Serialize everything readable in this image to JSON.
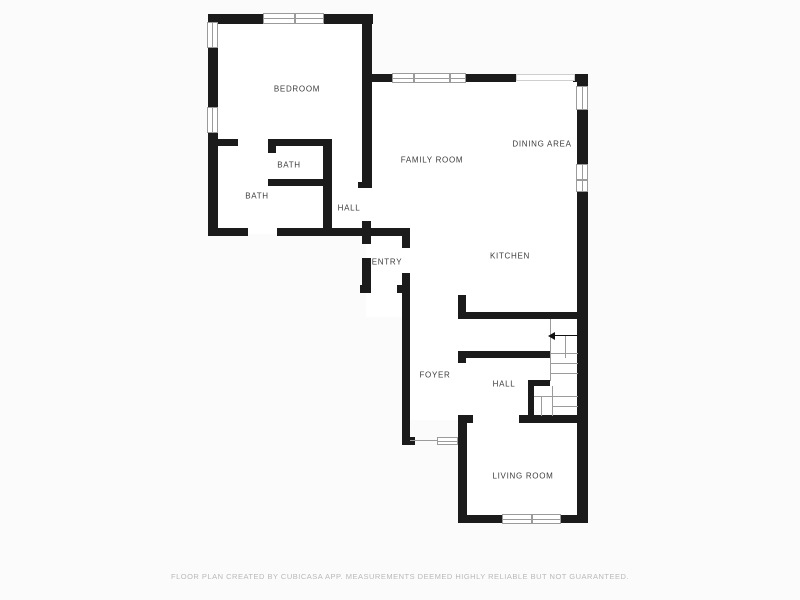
{
  "rooms": [
    {
      "label": "BEDROOM"
    },
    {
      "label": "BATH"
    },
    {
      "label": "BATH"
    },
    {
      "label": "HALL"
    },
    {
      "label": "FAMILY ROOM"
    },
    {
      "label": "DINING AREA"
    },
    {
      "label": "KITCHEN"
    },
    {
      "label": "ENTRY"
    },
    {
      "label": "FOYER"
    },
    {
      "label": "HALL"
    },
    {
      "label": "LIVING ROOM"
    }
  ],
  "footer": {
    "disclaimer": "FLOOR PLAN CREATED BY CUBICASA APP. MEASUREMENTS DEEMED HIGHLY RELIABLE BUT NOT GUARANTEED."
  },
  "icons": [
    {
      "name": "stair-direction-arrow",
      "meaning": "arrow pointing left at top of stairs"
    }
  ],
  "colors": {
    "wall": "#1b1b1b",
    "label": "#3c3c3c",
    "window_border": "#9b9b9b",
    "stair_line": "#9b9b9b",
    "disclaimer": "#b9b9b9",
    "background": "#fbfbfb",
    "room_fill": "#ffffff"
  }
}
